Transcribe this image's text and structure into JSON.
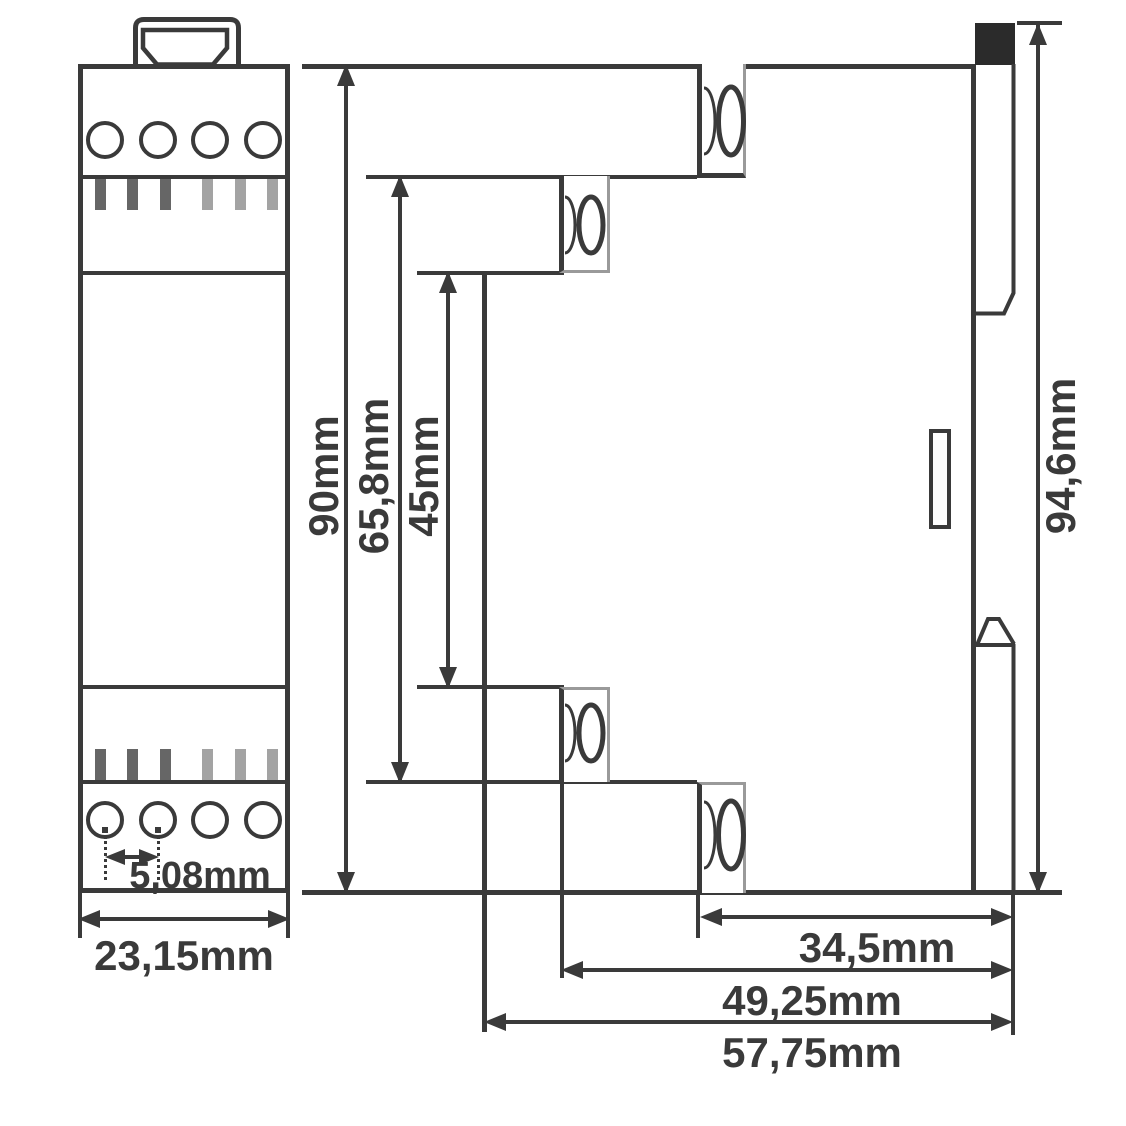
{
  "dims": {
    "terminal_pitch": "5,08mm",
    "module_width": "23,15mm",
    "housing_height": "90mm",
    "terminal_span_height": "65,8mm",
    "front_section_height": "45mm",
    "total_height": "94,6mm",
    "depth_upper_terminal": "34,5mm",
    "depth_lower_terminal": "49,25mm",
    "total_depth": "57,75mm"
  },
  "colors": {
    "line": "#3a3a3a",
    "light_edge": "#9a9a9a",
    "slot_dark": "#666666",
    "slot_light": "#a3a3a3",
    "din_clip_black": "#2b2b2b",
    "background": "#ffffff"
  }
}
